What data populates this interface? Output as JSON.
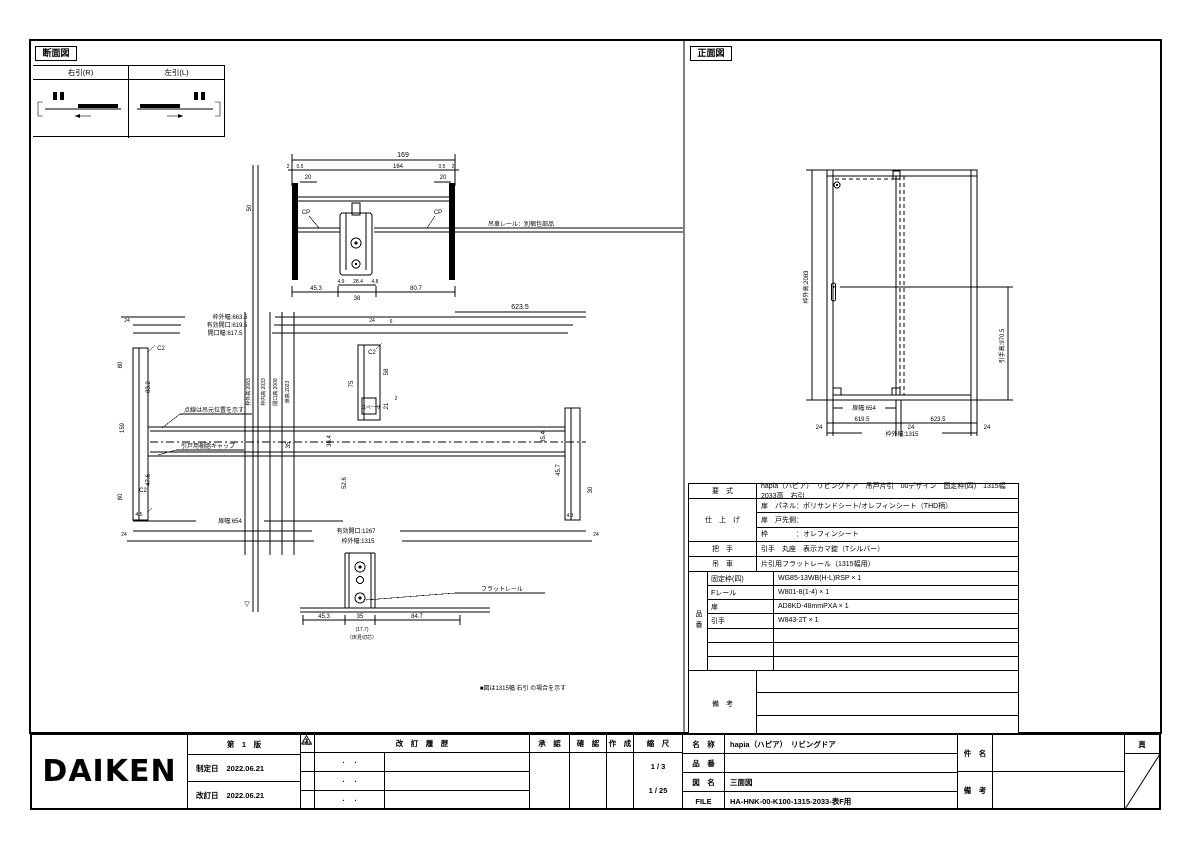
{
  "sheet": {
    "bg": "#ffffff",
    "ink": "#000000"
  },
  "left_panel": {
    "title": "断面図",
    "dir_table": {
      "right": "右引(R)",
      "left": "左引(L)"
    },
    "top_detail": {
      "w_total": "169",
      "d2l": "2",
      "d05l": "0.5",
      "w_inner": "164",
      "d05r": "0.5",
      "d2r": "2",
      "d20l": "20",
      "d20r": "20",
      "cp_l": "CP",
      "cp_r": "CP",
      "d50": "50",
      "rail_note": "吊車レール：別梱包部品",
      "d49": "4.9",
      "d284": "28.4",
      "d48": "4.8",
      "d453": "45.3",
      "d38": "38",
      "d807": "80.7"
    },
    "mid": {
      "d6235": "623.5",
      "w_out": "枠外幅:663.5",
      "w_eff": "有効開口:619.5",
      "w_open": "開口幅:617.5",
      "d24a": "24",
      "d24b": "24",
      "d6": "6",
      "c2_tl": "C2",
      "c2_bl": "C2",
      "c2_c": "C2",
      "d80t": "80",
      "d832": "83.2",
      "d159": "159",
      "d476": "47.6",
      "d80b": "80",
      "v1": "枠外高:2083",
      "v2": "枠内高:2033",
      "v3": "開口高:2008",
      "v4": "扉高:2023",
      "note_dash": "点線は吊元位置を示す",
      "cap_note": "引戸用樹脂キャップ",
      "d75": "75",
      "d58": "58",
      "d21": "21",
      "d2s": "2",
      "spacer": "スペーサ",
      "d364": "36.4",
      "d526": "52.6",
      "d35": "35",
      "d354": "35.4",
      "d457": "45.7",
      "d30": "30",
      "d43": "4.3",
      "d45": "4.5",
      "door_w": "扉幅:654",
      "d24c": "24",
      "d24d": "24",
      "w1267": "有効開口:1267",
      "w1315": "枠外幅:1315"
    },
    "bottom_detail": {
      "flat_rail": "フラットレール",
      "d453": "45.3",
      "d35": "35",
      "d847": "84.7",
      "d177": "(17.7)",
      "d177_note": "（床見切芯）",
      "fl_mark": "▽"
    },
    "note": "■図は1315幅 右引 の場合を示す"
  },
  "right_panel": {
    "title": "正面図",
    "elev": {
      "h_out": "枠外高:2083",
      "h_handle": "引手高:970.5",
      "door_w": "扉幅:654",
      "d24a": "24",
      "d6195": "619.5",
      "d24b": "24",
      "d6235": "623.5",
      "d24c": "24",
      "w_out": "枠外幅:1315"
    }
  },
  "spec": {
    "model_label": "要　式",
    "model_value": "hapia（ハピア）　リビングドア　吊戸片引　00デザイン　固定枠(四)　1315幅　2033高　右引",
    "finish_label": "仕　上　げ",
    "finish_row1": "扉　パネル：ポリサンドシート/オレフィンシート（THD柄）",
    "finish_row2": "扉　戸先側：",
    "finish_row3": "枠　　　　：オレフィンシート",
    "handle_label": "把　手",
    "handle_value": "引手　丸座　表示カマ錠（Tシルバー）",
    "rail_label": "吊　車",
    "rail_value": "片引用フラットレール（1315幅用）",
    "pn_label": "品番",
    "pn_rows": [
      {
        "name": "固定枠(四)",
        "value": "WG85-13WB(H-L)RSP × 1"
      },
      {
        "name": "Fレール",
        "value": "W801-8(1-4) × 1"
      },
      {
        "name": "扉",
        "value": "AD8KD-48mmPXA × 1"
      },
      {
        "name": "引手",
        "value": "W843-2T × 1"
      },
      {
        "name": "",
        "value": ""
      },
      {
        "name": "",
        "value": ""
      },
      {
        "name": "",
        "value": ""
      }
    ],
    "remarks_label": "備　考"
  },
  "title_block": {
    "logo": "DAIKEN",
    "edition": "第　1　版",
    "enacted_label": "制定日",
    "enacted_date": "2022.06.21",
    "revised_label": "改訂日",
    "revised_date": "2022.06.21",
    "no_header": "No.",
    "rev_header": "改　訂　履　歴",
    "rev_dots": "・　・",
    "rev_marks": [
      "1",
      "2",
      "3"
    ],
    "approve_label": "承　認",
    "check_label": "確　認",
    "create_label": "作　成",
    "scale_label": "縮　尺",
    "scale_detail": "1 / 3",
    "scale_overall": "1 / 25",
    "name_label": "名　称",
    "name_value": "hapia（ハピア）　リビングドア",
    "pn_label": "品　番",
    "pn_value": "",
    "dwg_label": "図　名",
    "dwg_value": "三面図",
    "file_label": "FILE",
    "file_value": "HA-HNK-00-K100-1315-2033-表F用",
    "subject_label": "件　名",
    "remarks_label2": "備　考",
    "page_label": "頁"
  }
}
